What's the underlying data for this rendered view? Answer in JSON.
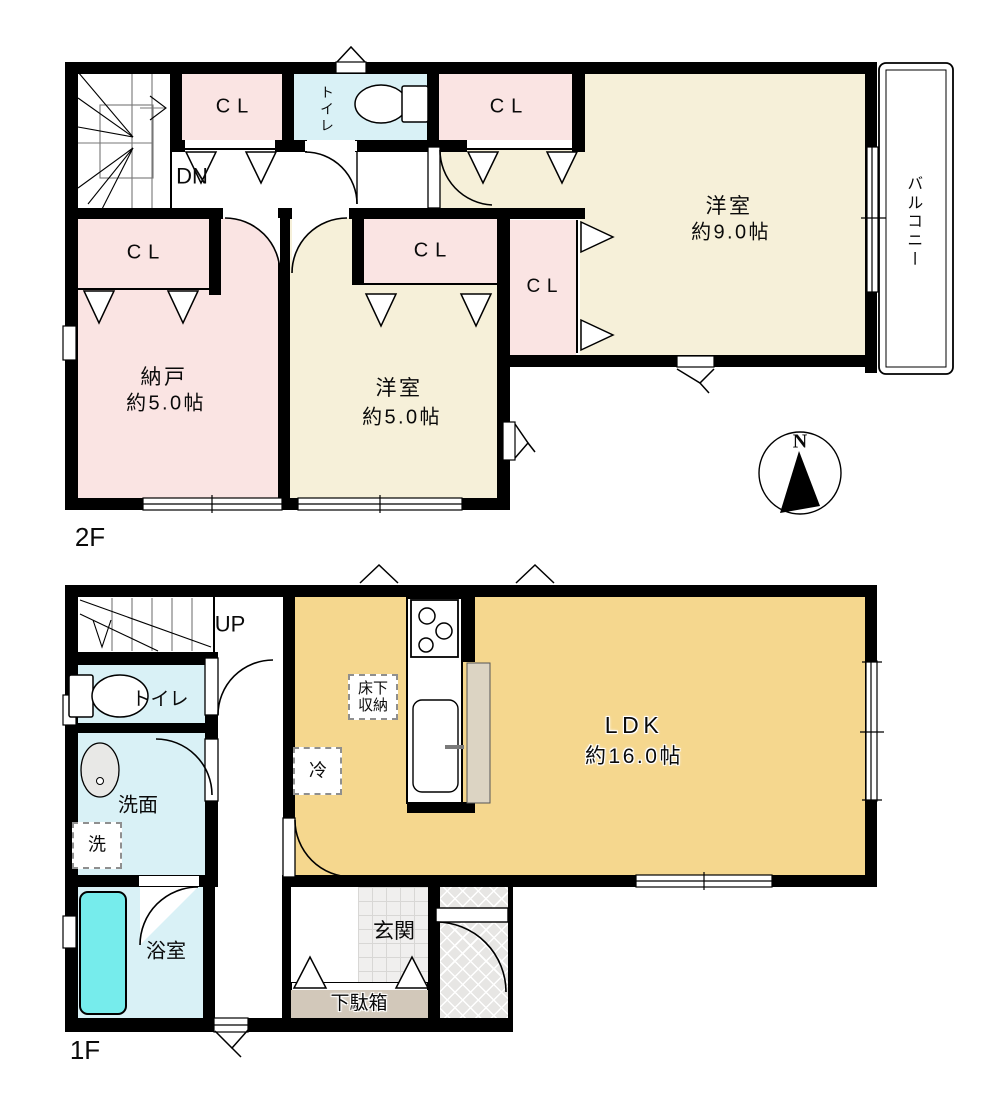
{
  "palette": {
    "wall": "#000000",
    "closet_pink": "#fae4e3",
    "western_room_cream": "#f6f0d9",
    "wet_area_blue": "#d9f1f6",
    "ldk_tan": "#f5d78e",
    "bathtub_cyan": "#76ecec",
    "shoe_cabinet_tan": "#d2c8ba",
    "kitchen_panel": "#dcd4c3"
  },
  "floor2": {
    "label": "2F",
    "stair": "DN",
    "cl1": "CL",
    "cl2": "CL",
    "cl3": "CL",
    "cl4": "CL",
    "cl5": "CL",
    "toilet": "トイレ",
    "room9_name": "洋室",
    "room9_area": "約9.0帖",
    "nando_name": "納戸",
    "nando_area": "約5.0帖",
    "room5_name": "洋室",
    "room5_area": "約5.0帖",
    "balcony": "バルコニー"
  },
  "floor1": {
    "label": "1F",
    "stair": "UP",
    "toilet": "トイレ",
    "washroom": "洗面",
    "washer": "洗",
    "bathroom": "浴室",
    "ldk_name": "LDK",
    "ldk_area": "約16.0帖",
    "underfloor_storage": "床下\n収納",
    "refrigerator": "冷",
    "entrance": "玄関",
    "shoe_cabinet": "下駄箱"
  },
  "compass_north": "N"
}
